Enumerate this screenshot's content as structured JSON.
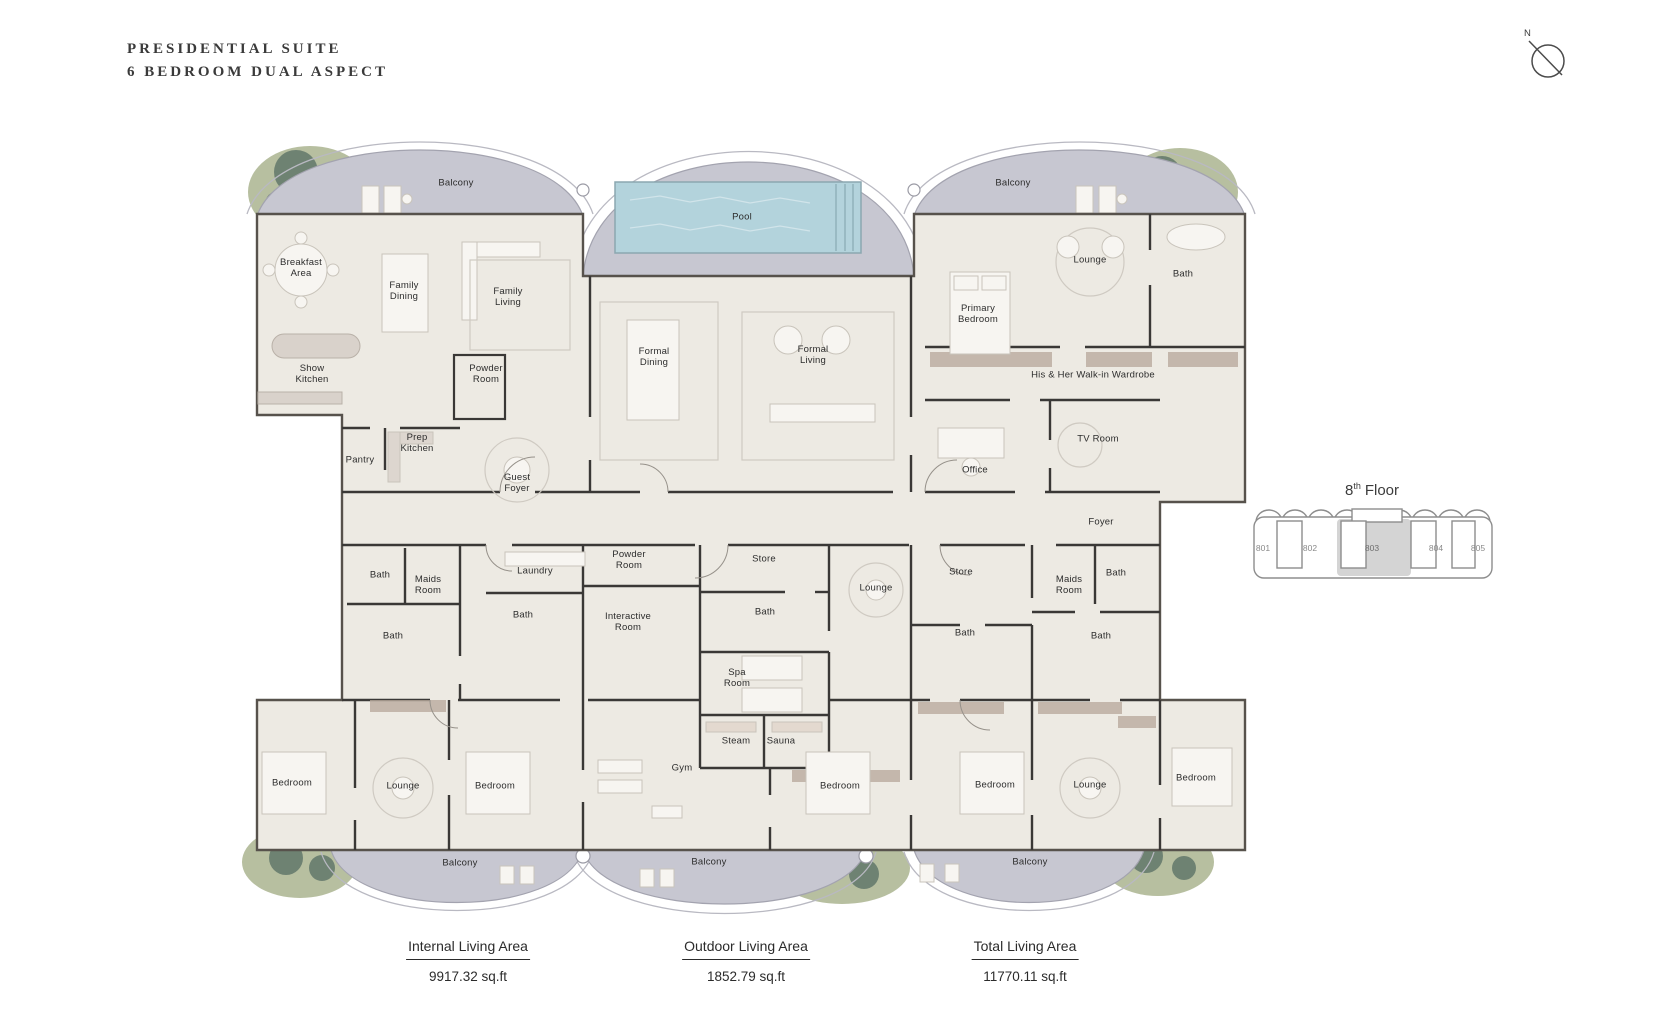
{
  "title": {
    "line1": "PRESIDENTIAL SUITE",
    "line2": "6 BEDROOM DUAL ASPECT"
  },
  "compass": {
    "label": "N"
  },
  "key_plan": {
    "floor_number": "8",
    "floor_suffix": "th",
    "floor_word": "Floor",
    "highlighted_unit": "803",
    "units": [
      {
        "id": "801",
        "x": 1263
      },
      {
        "id": "802",
        "x": 1310
      },
      {
        "id": "803",
        "x": 1372
      },
      {
        "id": "804",
        "x": 1436
      },
      {
        "id": "805",
        "x": 1478
      }
    ]
  },
  "stats": {
    "items": [
      {
        "label": "Internal Living Area",
        "value": "9917.32 sq.ft"
      },
      {
        "label": "Outdoor Living Area",
        "value": "1852.79 sq.ft"
      },
      {
        "label": "Total Living Area",
        "value": "11770.11 sq.ft"
      }
    ]
  },
  "colors": {
    "floor": "#edeae3",
    "balcony": "#c7c7d1",
    "pool": "#b3d3dc",
    "wall": "#3a3836",
    "landscape": "#b7bfa0",
    "tree": "#5e7468",
    "wood": "#b9aa9d",
    "highlight_unit": "#d4d4d4"
  },
  "floor_plan": {
    "labels": [
      {
        "text": "Balcony",
        "x": 456,
        "y": 183,
        "w": 80
      },
      {
        "text": "Pool",
        "x": 742,
        "y": 217,
        "w": 60
      },
      {
        "text": "Balcony",
        "x": 1013,
        "y": 183,
        "w": 80
      },
      {
        "text": "Breakfast Area",
        "x": 301,
        "y": 268,
        "w": 58
      },
      {
        "text": "Family Dining",
        "x": 404,
        "y": 291,
        "w": 50
      },
      {
        "text": "Family Living",
        "x": 508,
        "y": 297,
        "w": 50
      },
      {
        "text": "Lounge",
        "x": 1090,
        "y": 260,
        "w": 60
      },
      {
        "text": "Bath",
        "x": 1183,
        "y": 274,
        "w": 44
      },
      {
        "text": "Primary Bedroom",
        "x": 978,
        "y": 314,
        "w": 62
      },
      {
        "text": "Formal Dining",
        "x": 654,
        "y": 357,
        "w": 50
      },
      {
        "text": "Formal Living",
        "x": 813,
        "y": 355,
        "w": 50
      },
      {
        "text": "Show Kitchen",
        "x": 312,
        "y": 374,
        "w": 52
      },
      {
        "text": "Powder Room",
        "x": 486,
        "y": 374,
        "w": 54
      },
      {
        "text": "His & Her Walk-in Wardrobe",
        "x": 1093,
        "y": 375,
        "w": 210
      },
      {
        "text": "Prep Kitchen",
        "x": 417,
        "y": 443,
        "w": 52
      },
      {
        "text": "Pantry",
        "x": 360,
        "y": 460,
        "w": 50
      },
      {
        "text": "TV Room",
        "x": 1098,
        "y": 439,
        "w": 46
      },
      {
        "text": "Office",
        "x": 975,
        "y": 470,
        "w": 50
      },
      {
        "text": "Guest Foyer",
        "x": 517,
        "y": 483,
        "w": 46
      },
      {
        "text": "Foyer",
        "x": 1101,
        "y": 522,
        "w": 50
      },
      {
        "text": "Powder Room",
        "x": 629,
        "y": 560,
        "w": 54
      },
      {
        "text": "Store",
        "x": 764,
        "y": 559,
        "w": 50
      },
      {
        "text": "Laundry",
        "x": 535,
        "y": 571,
        "w": 60
      },
      {
        "text": "Store",
        "x": 961,
        "y": 572,
        "w": 50
      },
      {
        "text": "Bath",
        "x": 380,
        "y": 575,
        "w": 40
      },
      {
        "text": "Maids Room",
        "x": 428,
        "y": 585,
        "w": 48
      },
      {
        "text": "Bath",
        "x": 1116,
        "y": 573,
        "w": 40
      },
      {
        "text": "Maids Room",
        "x": 1069,
        "y": 585,
        "w": 48
      },
      {
        "text": "Lounge",
        "x": 876,
        "y": 588,
        "w": 60
      },
      {
        "text": "Bath",
        "x": 523,
        "y": 615,
        "w": 40
      },
      {
        "text": "Interactive Room",
        "x": 628,
        "y": 622,
        "w": 70
      },
      {
        "text": "Bath",
        "x": 765,
        "y": 612,
        "w": 40
      },
      {
        "text": "Bath",
        "x": 393,
        "y": 636,
        "w": 40
      },
      {
        "text": "Bath",
        "x": 965,
        "y": 633,
        "w": 40
      },
      {
        "text": "Bath",
        "x": 1101,
        "y": 636,
        "w": 40
      },
      {
        "text": "Spa Room",
        "x": 737,
        "y": 678,
        "w": 46
      },
      {
        "text": "Steam",
        "x": 736,
        "y": 741,
        "w": 50
      },
      {
        "text": "Sauna",
        "x": 781,
        "y": 741,
        "w": 50
      },
      {
        "text": "Gym",
        "x": 682,
        "y": 768,
        "w": 40
      },
      {
        "text": "Bedroom",
        "x": 292,
        "y": 783,
        "w": 64
      },
      {
        "text": "Lounge",
        "x": 403,
        "y": 786,
        "w": 56
      },
      {
        "text": "Bedroom",
        "x": 495,
        "y": 786,
        "w": 64
      },
      {
        "text": "Bedroom",
        "x": 840,
        "y": 786,
        "w": 64
      },
      {
        "text": "Bedroom",
        "x": 995,
        "y": 785,
        "w": 64
      },
      {
        "text": "Lounge",
        "x": 1090,
        "y": 785,
        "w": 56
      },
      {
        "text": "Bedroom",
        "x": 1196,
        "y": 778,
        "w": 64
      },
      {
        "text": "Balcony",
        "x": 460,
        "y": 863,
        "w": 60
      },
      {
        "text": "Balcony",
        "x": 709,
        "y": 862,
        "w": 60
      },
      {
        "text": "Balcony",
        "x": 1030,
        "y": 862,
        "w": 60
      }
    ]
  }
}
